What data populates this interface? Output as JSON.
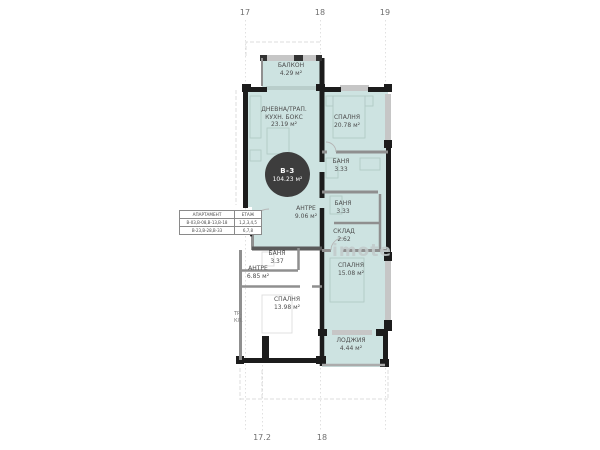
{
  "colors": {
    "unit_fill": "#cde3e1",
    "wall": "#1c1c1c",
    "window_gray": "#c6c6c6",
    "badge_bg": "#3d3d3d",
    "label_text": "#4d4d4d",
    "watermark": "#c3cbcb"
  },
  "grid": {
    "top_labels": [
      "17",
      "18",
      "19"
    ],
    "bottom_labels": [
      "17.2",
      "18"
    ]
  },
  "badge": {
    "unit": "В-3",
    "area": "104.23 м²"
  },
  "rooms": {
    "balcony": {
      "name": "БАЛКОН",
      "area": "4.29 м²"
    },
    "living": {
      "name": "ДНЕВНА/ТРАП.",
      "name2": "КУХН. БОКС",
      "area": "23.19 м²"
    },
    "bedroom1": {
      "name": "СПАЛНЯ",
      "area": "20.78 м²"
    },
    "bath1": {
      "name": "БАНЯ",
      "area": "3.33"
    },
    "bath2": {
      "name": "БАНЯ",
      "area": "3.33"
    },
    "storage": {
      "name": "СКЛАД",
      "area": "2.62"
    },
    "hall": {
      "name": "АНТРЕ",
      "area": "9.06 м²"
    },
    "bedroom2": {
      "name": "СПАЛНЯ",
      "area": "15.08 м²"
    },
    "loggia": {
      "name": "ЛОДЖИЯ",
      "area": "4.44 м²"
    }
  },
  "neighbor_rooms": {
    "bath": {
      "name": "БАНЯ",
      "area": "3.37"
    },
    "hall": {
      "name": "АНТРЕ",
      "area": "6.85 м²"
    },
    "bedroom": {
      "name": "СПАЛНЯ",
      "area": "13.98 м²"
    },
    "stair": {
      "line1": "ТР.",
      "line2": "КЛ."
    }
  },
  "legend": {
    "headers": [
      "АПАРТАМЕНТ",
      "ЕТАЖ"
    ],
    "rows": [
      [
        "В-03,В-08,В-13,В-18",
        "1,2,3,4,5"
      ],
      [
        "В-23,В-28,В-33",
        "6,7,8"
      ]
    ]
  },
  "watermark": "imote"
}
